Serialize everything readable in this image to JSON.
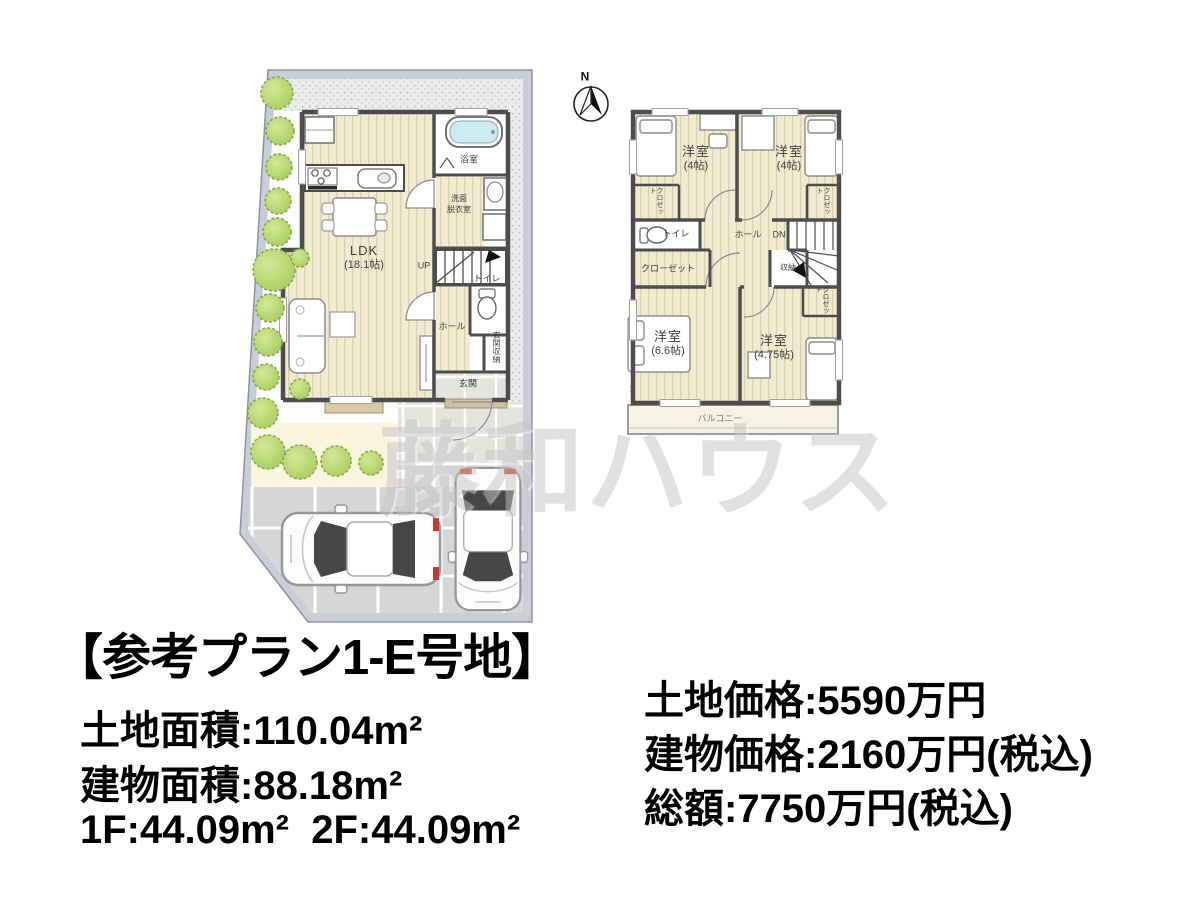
{
  "watermark_text": "藤和ハウス",
  "compass": {
    "north_label": "N"
  },
  "floor1": {
    "ldk": "LDK",
    "ldk_size": "(18.1帖)",
    "bath": "浴室",
    "washroom_line1": "洗面",
    "washroom_line2": "脱衣室",
    "stairs": "UP",
    "hall": "ホール",
    "toilet": "トイレ",
    "entrance_storage": "玄関収納",
    "entrance": "玄関"
  },
  "floor2": {
    "room_nw": "洋室",
    "room_nw_size": "(4帖)",
    "room_ne": "洋室",
    "room_ne_size": "(4帖)",
    "closet_nw": "クロゼット",
    "closet_ne": "クロゼット",
    "closet_se": "クロゼット",
    "toilet": "トイレ",
    "hall": "ホール",
    "stairs": "DN",
    "storage": "収納",
    "closet_main": "クローゼット",
    "room_sw": "洋室",
    "room_sw_size": "(6.6帖)",
    "room_se": "洋室",
    "room_se_size": "(4.75帖)",
    "balcony": "バルコニー"
  },
  "summary": {
    "title": "【参考プラン1-E号地】",
    "land_area": "土地面積:110.04m²",
    "building_area": "建物面積:88.18m²",
    "floor_areas": "1F:44.09m²  2F:44.09m²",
    "land_price": "土地価格:5590万円",
    "building_price": "建物価格:2160万円(税込)",
    "total_price": "総額:7750万円(税込)"
  },
  "colors": {
    "wall": "#4d4d4d",
    "floor_wood": "#f1ebd2",
    "floor_stripe": "#ddd2ad",
    "tree_green": "#b7d76b",
    "site_band": "#c9cdd6",
    "parking_tile": "#d6d6d4",
    "tub_blue": "#cdebf2",
    "watermark_gray": "#c4c4c4",
    "text_black": "#000000"
  }
}
